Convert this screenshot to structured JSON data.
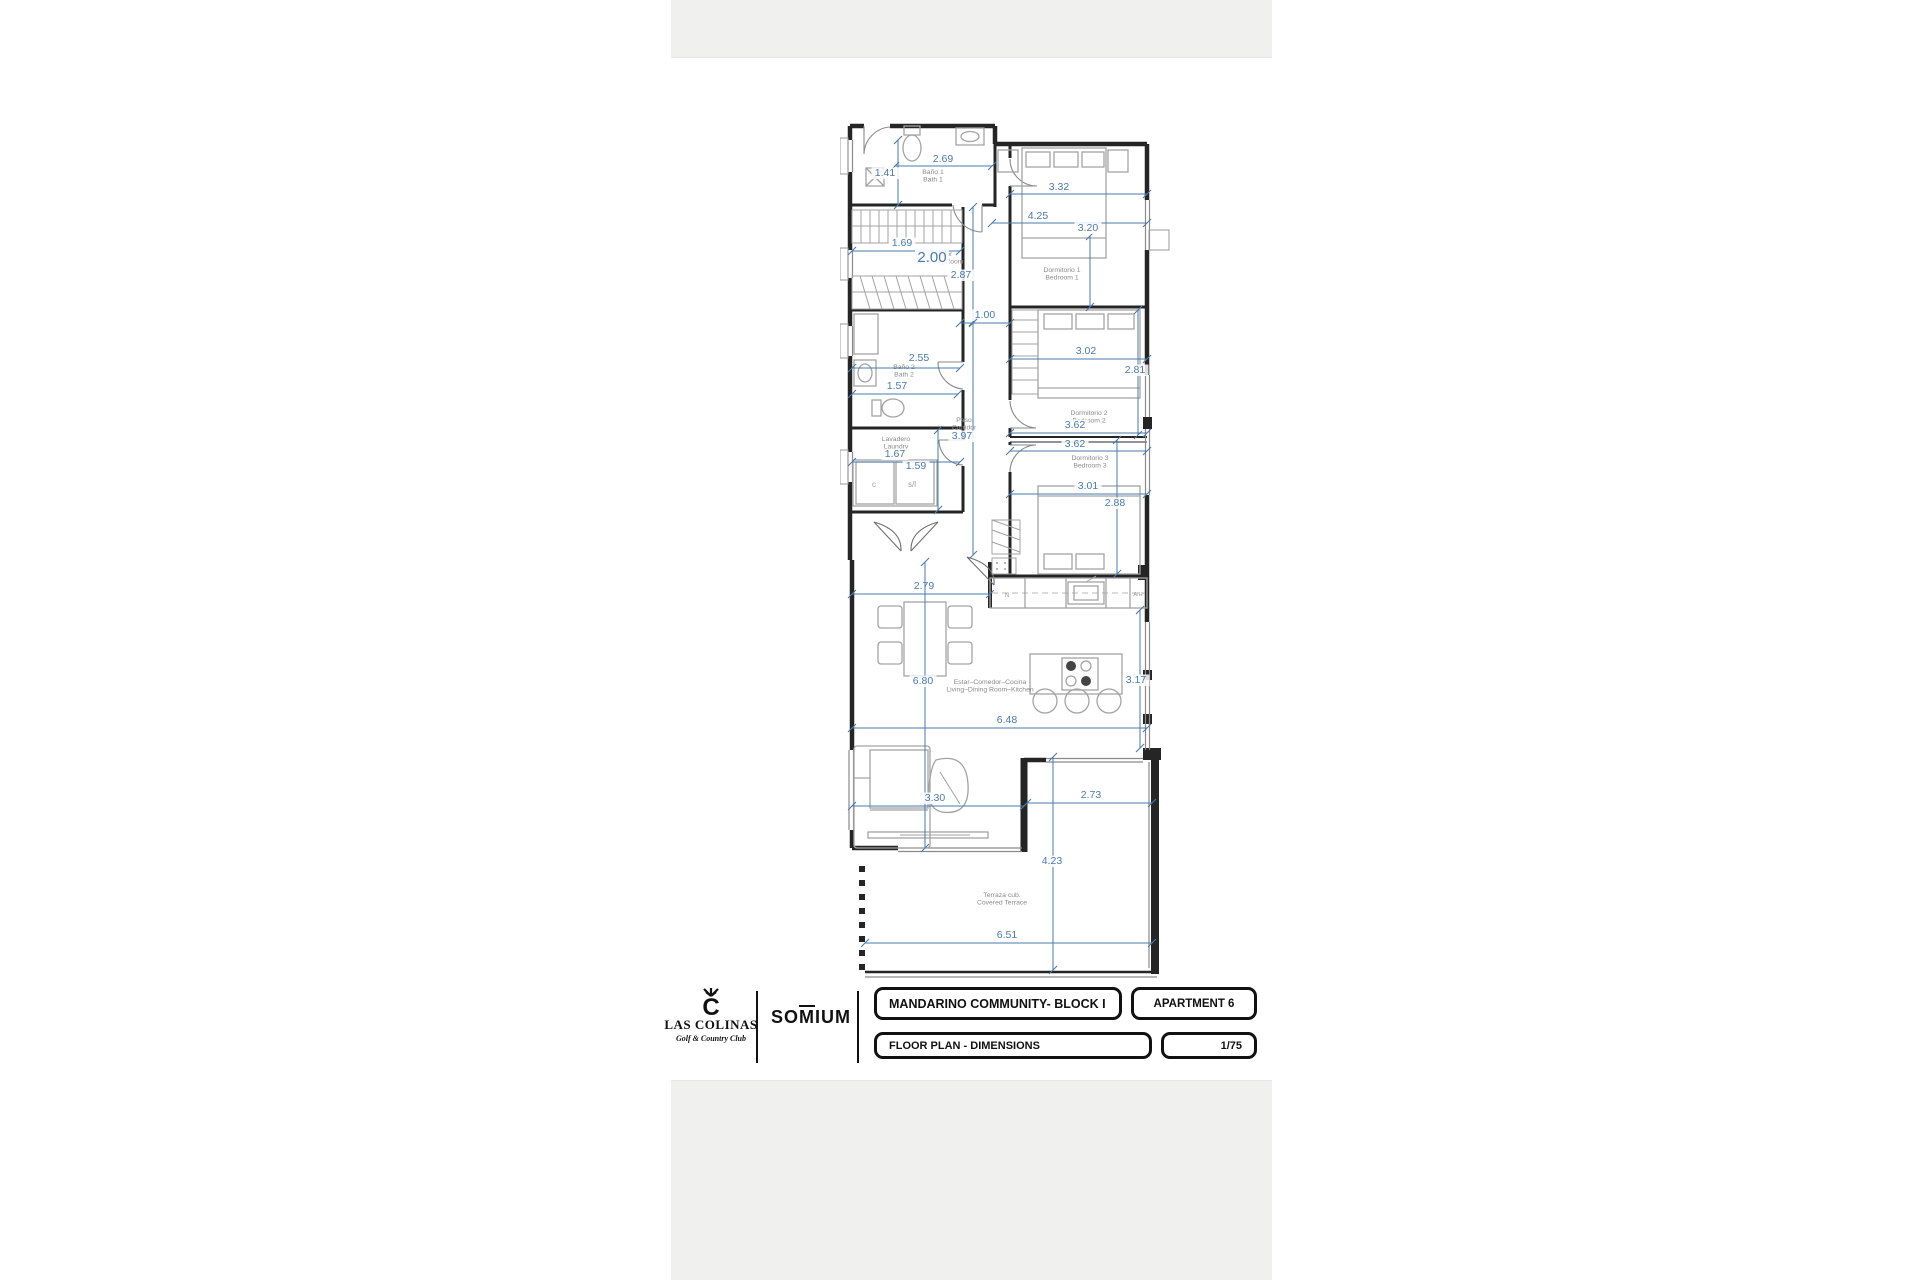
{
  "document": {
    "brand": {
      "name": "LAS COLINAS",
      "tagline": "Golf & Country Club",
      "partner_prefix": "SO",
      "partner_macron": "M",
      "partner_suffix": "IUM"
    },
    "title_block": {
      "project": "MANDARINO COMMUNITY- BLOCK I",
      "unit": "APARTMENT 6",
      "drawing": "FLOOR PLAN - DIMENSIONS",
      "scale": "1/75"
    }
  },
  "colors": {
    "dimension_blue": "#4a7aac",
    "wall_black": "#252525",
    "label_gray": "#8a8a8a",
    "furniture_gray": "#a3a3a3",
    "gutter_gray": "#f0f0ef"
  },
  "floor_plan": {
    "rooms": [
      {
        "id": "bath-1",
        "name_es": "Baño 1",
        "name_en": "Bath 1",
        "x": 93,
        "y": 64
      },
      {
        "id": "dressing-room",
        "name_es": "Vestidor",
        "name_en": "Dressing Room",
        "x": 100,
        "y": 146
      },
      {
        "id": "bedroom-1",
        "name_es": "Dormitorio 1",
        "name_en": "Bedroom 1",
        "x": 222,
        "y": 162
      },
      {
        "id": "bath-2",
        "name_es": "Baño 2",
        "name_en": "Bath 2",
        "x": 64,
        "y": 259
      },
      {
        "id": "corridor",
        "name_es": "Paso",
        "name_en": "Corridor",
        "x": 124,
        "y": 312
      },
      {
        "id": "laundry",
        "name_es": "Lavadero",
        "name_en": "Laundry",
        "x": 56,
        "y": 331
      },
      {
        "id": "bedroom-2",
        "name_es": "Dormitorio 2",
        "name_en": "Bedroom 2",
        "x": 249,
        "y": 305
      },
      {
        "id": "bedroom-3",
        "name_es": "Dormitorio 3",
        "name_en": "Bedroom 3",
        "x": 250,
        "y": 350
      },
      {
        "id": "living-kitchen",
        "name_es": "Estar–Comedor–Cocina",
        "name_en": "Living–Dining Room–Kitchen",
        "x": 150,
        "y": 574
      },
      {
        "id": "terrace",
        "name_es": "Terraza cub.",
        "name_en": "Covered Terrace",
        "x": 162,
        "y": 787
      }
    ],
    "dimensions": [
      {
        "value": "2.69",
        "orient": "h",
        "x1": 55,
        "x2": 152,
        "y": 56,
        "tx": 103,
        "ty": 52
      },
      {
        "value": "1.41",
        "orient": "v",
        "x": 58,
        "y1": 30,
        "y2": 95,
        "tx": 45,
        "ty": 66
      },
      {
        "value": "3.32",
        "orient": "h",
        "x1": 170,
        "x2": 307,
        "y": 84,
        "tx": 219,
        "ty": 80
      },
      {
        "value": "4.25",
        "orient": "h",
        "x1": 152,
        "x2": 307,
        "y": 113,
        "tx": 198,
        "ty": 109
      },
      {
        "value": "3.20",
        "orient": "v",
        "x": 250,
        "y1": 126,
        "y2": 197,
        "tx": 248,
        "ty": 121
      },
      {
        "value": "1.69",
        "orient": "h",
        "x1": 12,
        "x2": 120,
        "y": 141,
        "tx": 62,
        "ty": 136
      },
      {
        "value": "2.00",
        "orient": "none",
        "tx": 92,
        "ty": 152,
        "big": true
      },
      {
        "value": "2.87",
        "orient": "v",
        "x": 133,
        "y1": 97,
        "y2": 212,
        "tx": 121,
        "ty": 168
      },
      {
        "value": "1.00",
        "orient": "h",
        "x1": 120,
        "x2": 170,
        "y": 213,
        "tx": 145,
        "ty": 208
      },
      {
        "value": "2.55",
        "orient": "h",
        "x1": 12,
        "x2": 120,
        "y": 258,
        "tx": 79,
        "ty": 251
      },
      {
        "value": "1.57",
        "orient": "h",
        "x1": 12,
        "x2": 118,
        "y": 284,
        "tx": 57,
        "ty": 279
      },
      {
        "value": "3.02",
        "orient": "h",
        "x1": 170,
        "x2": 307,
        "y": 249,
        "tx": 246,
        "ty": 244
      },
      {
        "value": "2.81",
        "orient": "v",
        "x": 298,
        "y1": 200,
        "y2": 325,
        "tx": 295,
        "ty": 263
      },
      {
        "value": "3.62",
        "orient": "h",
        "x1": 170,
        "x2": 307,
        "y": 323,
        "tx": 235,
        "ty": 318
      },
      {
        "value": "3.62",
        "orient": "h",
        "x1": 170,
        "x2": 307,
        "y": 341,
        "tx": 235,
        "ty": 337
      },
      {
        "value": "1.67",
        "orient": "h",
        "x1": 12,
        "x2": 120,
        "y": 352,
        "tx": 55,
        "ty": 347
      },
      {
        "value": "1.59",
        "orient": "v",
        "x": 98,
        "y1": 320,
        "y2": 400,
        "tx": 76,
        "ty": 359
      },
      {
        "value": "3.97",
        "orient": "v",
        "x": 133,
        "y1": 213,
        "y2": 445,
        "tx": 122,
        "ty": 329
      },
      {
        "value": "3.01",
        "orient": "h",
        "x1": 170,
        "x2": 307,
        "y": 384,
        "tx": 248,
        "ty": 379
      },
      {
        "value": "2.88",
        "orient": "v",
        "x": 277,
        "y1": 330,
        "y2": 464,
        "tx": 275,
        "ty": 396
      },
      {
        "value": "2.79",
        "orient": "h",
        "x1": 12,
        "x2": 150,
        "y": 484,
        "tx": 84,
        "ty": 479
      },
      {
        "value": "6.80",
        "orient": "v",
        "x": 85,
        "y1": 452,
        "y2": 738,
        "tx": 83,
        "ty": 574
      },
      {
        "value": "3.17",
        "orient": "v",
        "x": 300,
        "y1": 500,
        "y2": 638,
        "tx": 296,
        "ty": 573
      },
      {
        "value": "6.48",
        "orient": "h",
        "x1": 12,
        "x2": 307,
        "y": 618,
        "tx": 167,
        "ty": 613
      },
      {
        "value": "3.30",
        "orient": "h",
        "x1": 12,
        "x2": 184,
        "y": 696,
        "tx": 95,
        "ty": 691
      },
      {
        "value": "2.73",
        "orient": "h",
        "x1": 187,
        "x2": 312,
        "y": 693,
        "tx": 251,
        "ty": 688
      },
      {
        "value": "4.23",
        "orient": "v",
        "x": 213,
        "y1": 647,
        "y2": 860,
        "tx": 212,
        "ty": 754
      },
      {
        "value": "6.51",
        "orient": "h",
        "x1": 25,
        "x2": 312,
        "y": 833,
        "tx": 167,
        "ty": 828
      }
    ],
    "annotations": [
      {
        "text": "A/H",
        "x": 298,
        "y": 486,
        "size": 5.5
      },
      {
        "text": "c",
        "x": 34,
        "y": 377,
        "size": 8
      },
      {
        "text": "s/l",
        "x": 72,
        "y": 377,
        "size": 8
      },
      {
        "text": "N",
        "x": 167,
        "y": 487,
        "size": 6
      }
    ]
  }
}
